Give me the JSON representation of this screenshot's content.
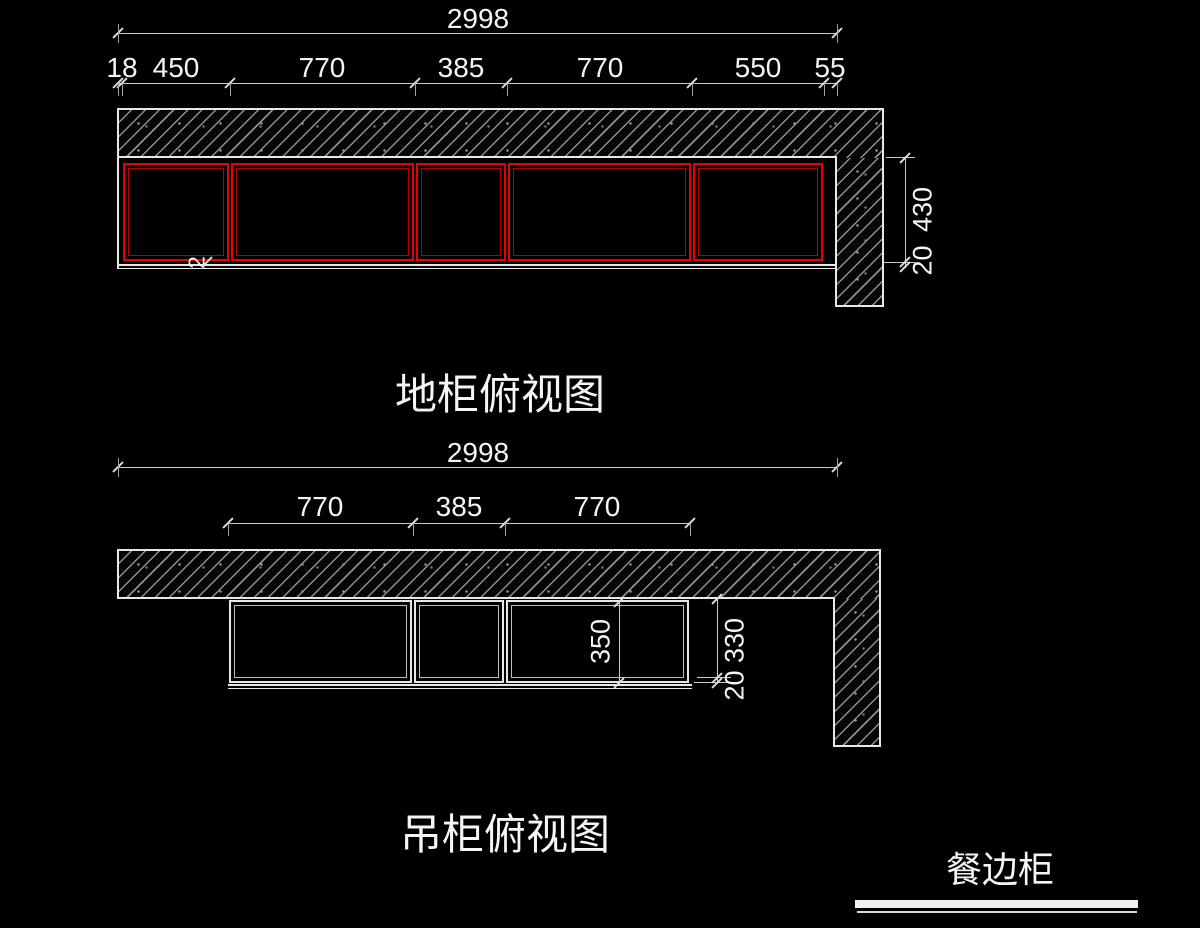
{
  "drawing1": {
    "title": "地柜俯视图",
    "overall_dim": "2998",
    "chain_dims": [
      "18",
      "450",
      "770",
      "385",
      "770",
      "550",
      "55"
    ],
    "side_dims": {
      "depth": "430",
      "gap": "20"
    },
    "stray_dim": "2"
  },
  "drawing2": {
    "title": "吊柜俯视图",
    "overall_dim": "2998",
    "chain_dims": [
      "770",
      "385",
      "770"
    ],
    "inner_depth": "350",
    "side_dims": {
      "depth": "330",
      "gap": "20"
    }
  },
  "legend": {
    "label": "餐边柜"
  },
  "colors": {
    "background": "#000000",
    "wall_outline": "#e8e8e8",
    "hatch_line": "#8f8f8f",
    "cabinet_red": "#e60000",
    "dim_line": "#c9c9c9",
    "text": "#f4f4f4"
  }
}
